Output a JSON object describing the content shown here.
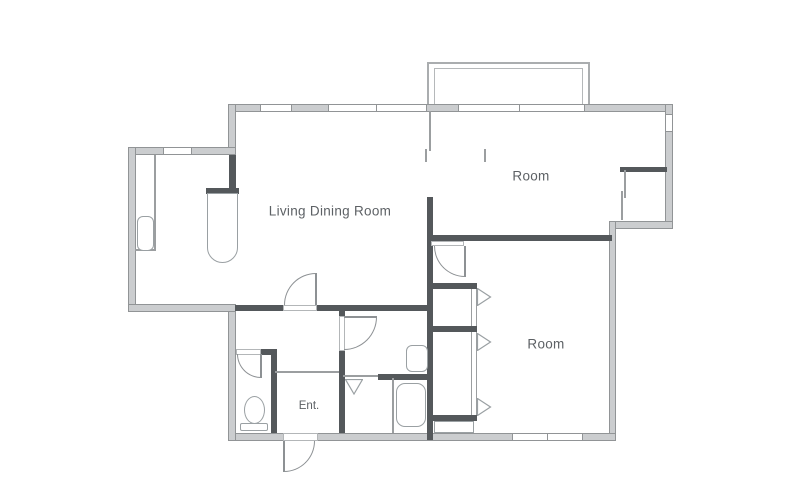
{
  "floor_plan": {
    "rooms": [
      {
        "id": "living_dining",
        "label": "Living Dining Room"
      },
      {
        "id": "room_top",
        "label": "Room"
      },
      {
        "id": "room_bottom",
        "label": "Room"
      },
      {
        "id": "entrance",
        "label": "Ent."
      }
    ],
    "colors": {
      "background": "#ffffff",
      "exterior_wall_fill": "#cbcdcf",
      "exterior_wall_edge": "#919496",
      "interior_wall": "#54585b",
      "thin_line": "#9b9ea0",
      "fixture_outline": "#9aa0a3",
      "label_text": "#5d6165"
    },
    "fixtures": [
      "balcony",
      "windows",
      "sliding-doors",
      "hinged-doors",
      "folding-doors",
      "kitchen-counter",
      "kitchen-sink",
      "toilet",
      "washbasin",
      "bathtub",
      "closets"
    ]
  }
}
